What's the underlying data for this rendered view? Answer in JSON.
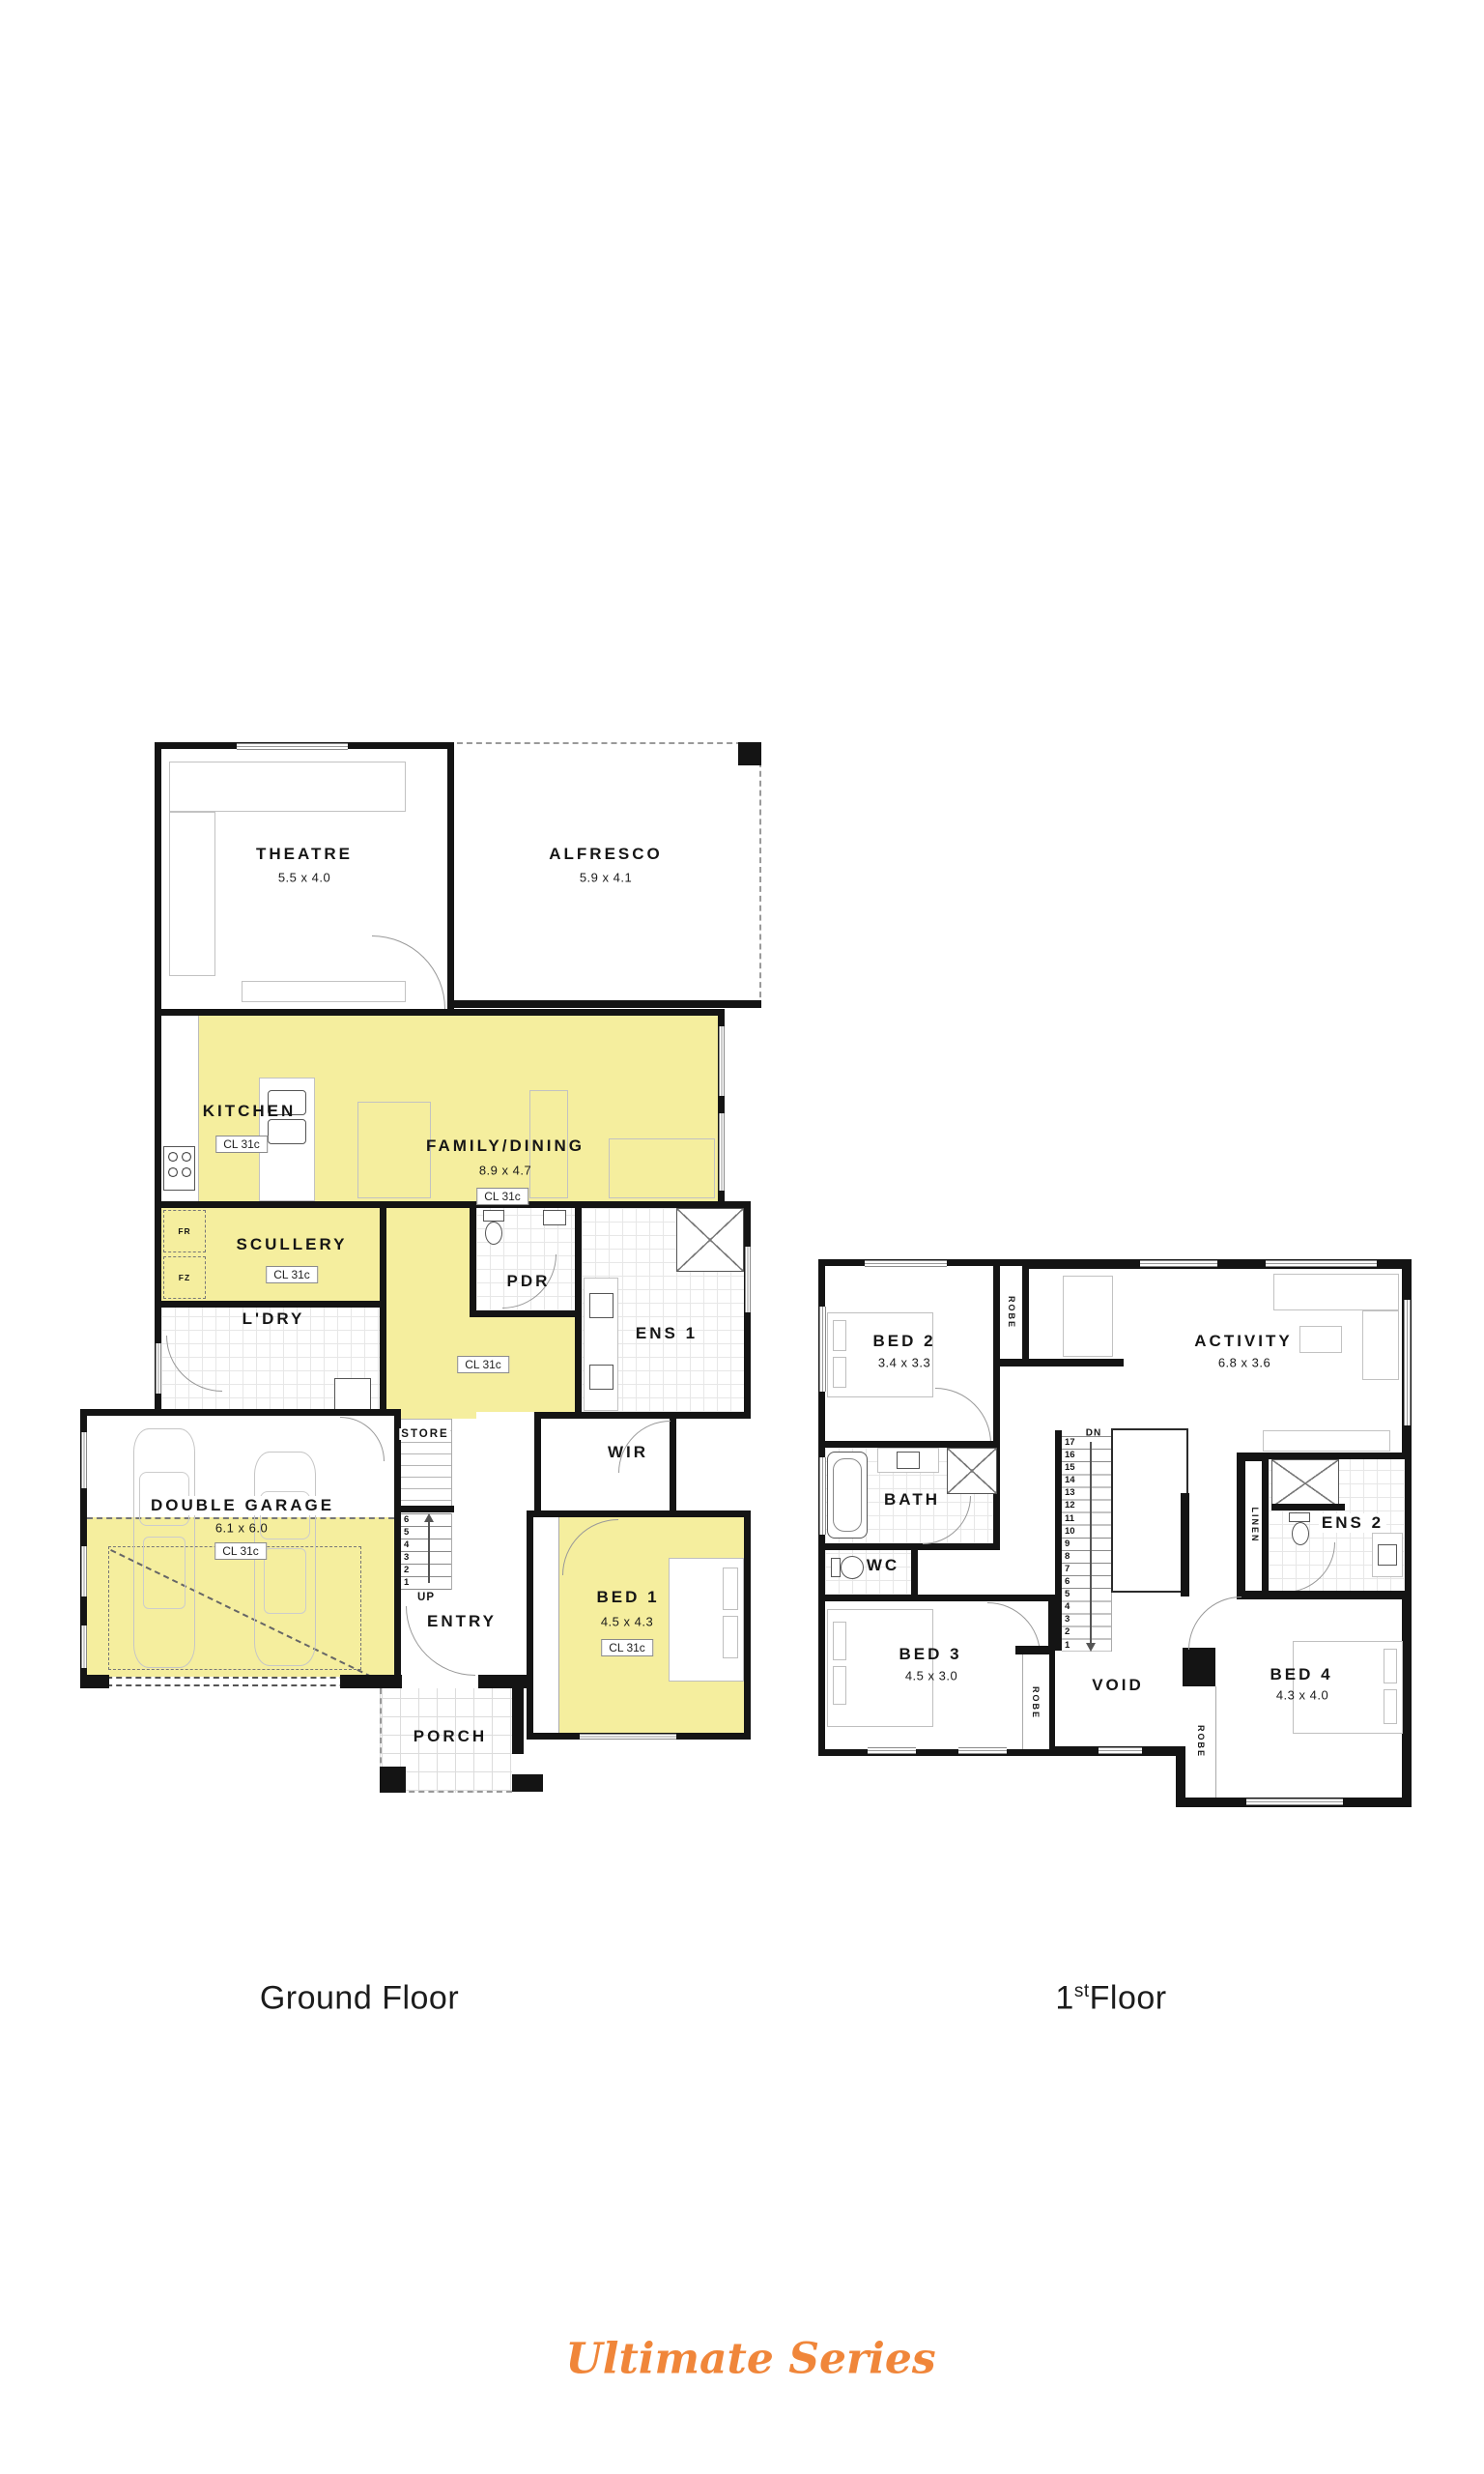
{
  "colors": {
    "highlight": "#F5EE9E",
    "wall": "#141414",
    "brand_orange": "#F0863A"
  },
  "ground_floor": {
    "title": "Ground Floor",
    "rooms": {
      "theatre": {
        "name": "THEATRE",
        "dim": "5.5 x 4.0"
      },
      "alfresco": {
        "name": "ALFRESCO",
        "dim": "5.9 x 4.1"
      },
      "kitchen": {
        "name": "KITCHEN",
        "ceiling": "CL 31c"
      },
      "family_dining": {
        "name": "FAMILY/DINING",
        "dim": "8.9 x 4.7",
        "ceiling": "CL 31c"
      },
      "scullery": {
        "name": "SCULLERY",
        "ceiling": "CL 31c",
        "fridge": "FR",
        "freezer": "FZ"
      },
      "laundry": {
        "name": "L'DRY"
      },
      "powder": {
        "name": "PDR"
      },
      "hall": {
        "ceiling": "CL 31c"
      },
      "ens1": {
        "name": "ENS 1"
      },
      "wir": {
        "name": "WIR"
      },
      "store": {
        "name": "STORE"
      },
      "stairs": {
        "treads": [
          "6",
          "5",
          "4",
          "3",
          "2",
          "1"
        ],
        "direction": "UP"
      },
      "entry": {
        "name": "ENTRY"
      },
      "garage": {
        "name": "DOUBLE GARAGE",
        "dim": "6.1 x 6.0",
        "ceiling": "CL 31c"
      },
      "bed1": {
        "name": "BED 1",
        "dim": "4.5 x 4.3",
        "ceiling": "CL 31c"
      },
      "porch": {
        "name": "PORCH"
      }
    }
  },
  "first_floor": {
    "title_prefix": "1",
    "title_sup": "st",
    "title_suffix": "Floor",
    "rooms": {
      "bed2": {
        "name": "BED 2",
        "dim": "3.4 x 3.3",
        "robe": "ROBE"
      },
      "activity": {
        "name": "ACTIVITY",
        "dim": "6.8 x 3.6"
      },
      "bath": {
        "name": "BATH"
      },
      "wc": {
        "name": "WC"
      },
      "linen": {
        "name": "LINEN"
      },
      "ens2": {
        "name": "ENS 2"
      },
      "stairs": {
        "treads": [
          "17",
          "16",
          "15",
          "14",
          "13",
          "12",
          "11",
          "10",
          "9",
          "8",
          "7",
          "6",
          "5",
          "4",
          "3",
          "2",
          "1"
        ],
        "direction": "DN"
      },
      "bed3": {
        "name": "BED 3",
        "dim": "4.5 x 3.0",
        "robe": "ROBE"
      },
      "void": {
        "name": "VOID"
      },
      "bed4": {
        "name": "BED 4",
        "dim": "4.3 x 4.0",
        "robe": "ROBE"
      }
    }
  },
  "brand": {
    "series": "Ultimate Series"
  }
}
